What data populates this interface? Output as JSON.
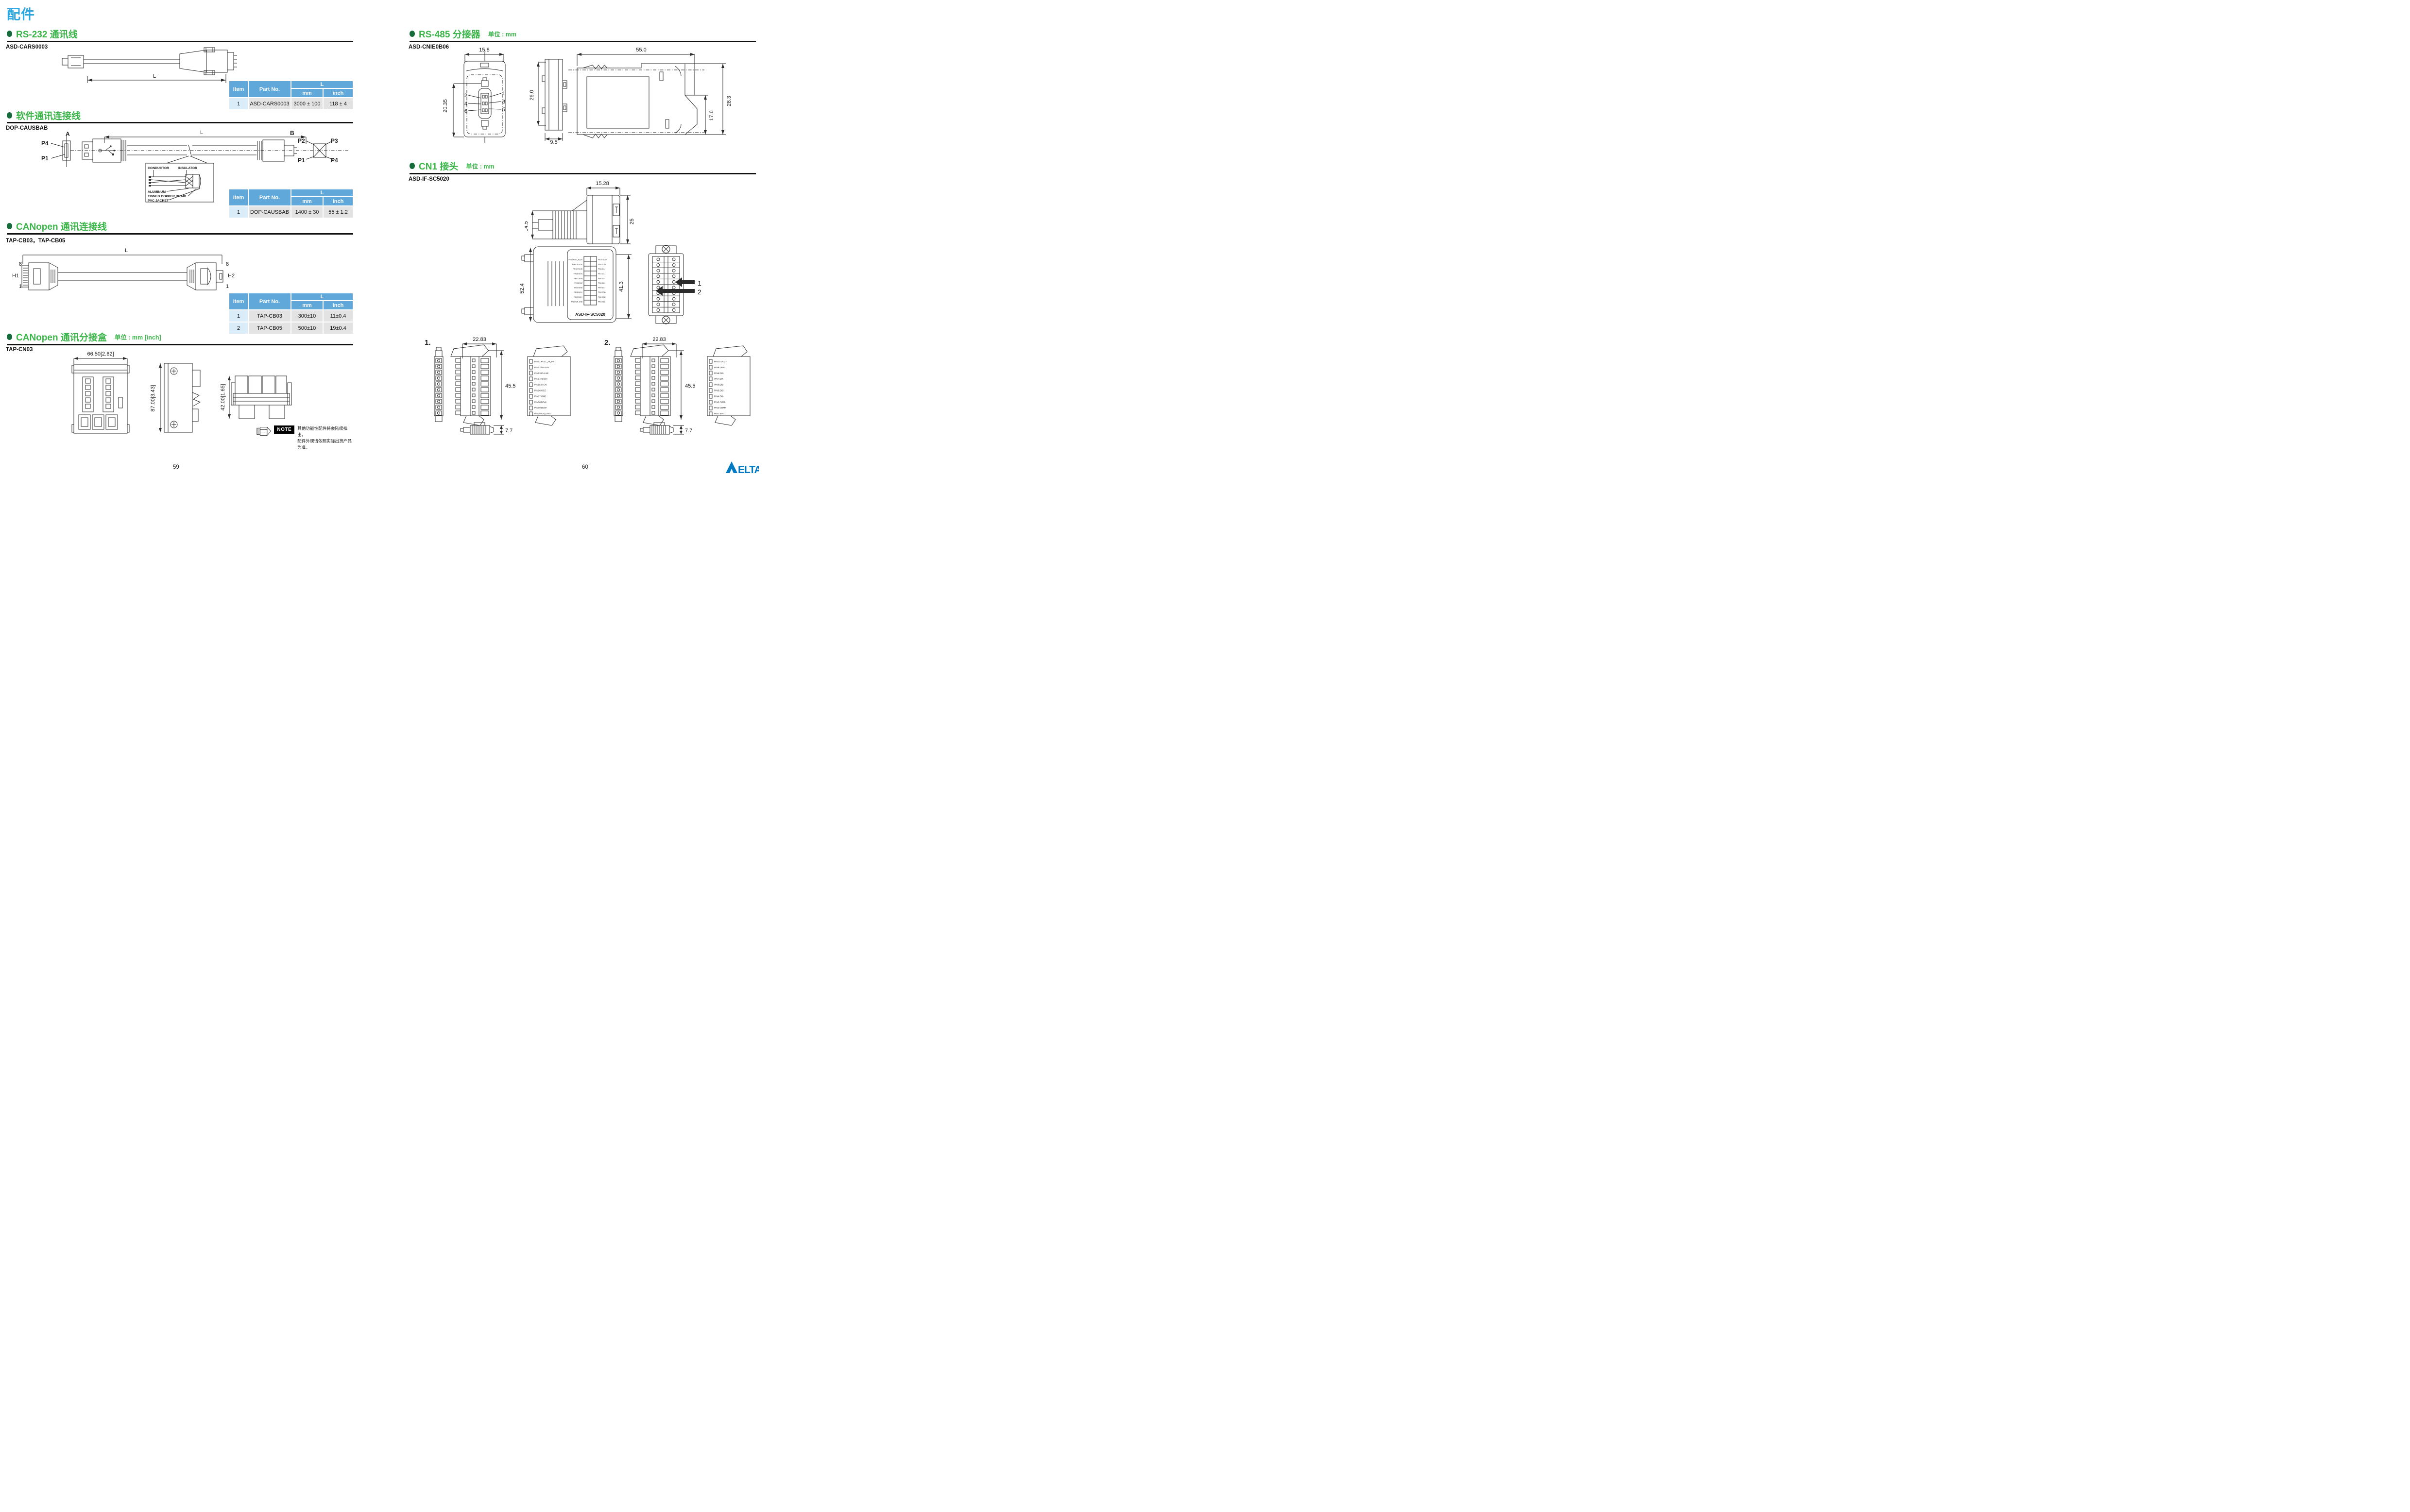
{
  "doc": {
    "title": "配件"
  },
  "pages": {
    "left_number": "59",
    "right_number": "60"
  },
  "colors": {
    "accent_blue": "#2EA7E0",
    "section_green": "#3BB54A",
    "bullet_green": "#156B3A",
    "table_header_blue": "#61A8DA",
    "table_item_bg": "#D9ECF8",
    "table_cell_bg": "#E3E3E3",
    "delta_blue": "#0079C1"
  },
  "rs232": {
    "title": "RS-232 通讯线",
    "part_no": "ASD-CARS0003",
    "dim_l": "L",
    "table": {
      "h_item": "Item",
      "h_part": "Part No.",
      "h_l": "L",
      "h_mm": "mm",
      "h_inch": "inch",
      "rows": [
        {
          "item": "1",
          "part": "ASD-CARS0003",
          "mm": "3000 ± 100",
          "inch": "118 ± 4"
        }
      ]
    }
  },
  "software": {
    "title": "软件通讯连接线",
    "part_no": "DOP-CAUSBAB",
    "dim_l": "L",
    "end_a": "A",
    "end_b": "B",
    "pa_top": "P4",
    "pa_bottom": "P1",
    "pb_tl": "P2",
    "pb_tr": "P3",
    "pb_bl": "P1",
    "pb_br": "P4",
    "detail": {
      "conductor": "CONDUCTOR",
      "insulator": "INSULATOR",
      "aluminum": "ALUMINUM",
      "braid": "TINNED COPPER BRAID",
      "jacket": "PVC JACKET"
    },
    "table": {
      "h_item": "Item",
      "h_part": "Part No.",
      "h_l": "L",
      "h_mm": "mm",
      "h_inch": "inch",
      "rows": [
        {
          "item": "1",
          "part": "DOP-CAUSBAB",
          "mm": "1400 ± 30",
          "inch": "55 ± 1.2"
        }
      ]
    }
  },
  "canopen_cable": {
    "title": "CANopen 通讯连接线",
    "part_no": "TAP-CB03，TAP-CB05",
    "dim_l": "L",
    "h1": "H1",
    "h2": "H2",
    "pin_top": "8",
    "pin_bottom": "1",
    "table": {
      "h_item": "Item",
      "h_part": "Part No.",
      "h_l": "L",
      "h_mm": "mm",
      "h_inch": "inch",
      "rows": [
        {
          "item": "1",
          "part": "TAP-CB03",
          "mm": "300±10",
          "inch": "11±0.4"
        },
        {
          "item": "2",
          "part": "TAP-CB05",
          "mm": "500±10",
          "inch": "19±0.4"
        }
      ]
    }
  },
  "canopen_tap": {
    "title": "CANopen 通讯分接盒",
    "unit": "单位 : mm [inch]",
    "part_no": "TAP-CN03",
    "dim_w": "66.50[2.62]",
    "dim_h": "87.00[3.43]",
    "dim_d": "42.00[1.65]",
    "note_label": "NOTE",
    "note_line1": "其他功能性配件将会陆续推出。",
    "note_line2": "配件外观请依照实际出货产品为准。"
  },
  "rs485": {
    "title": "RS-485 分接器",
    "unit": "单位 : mm",
    "part_no": "ASD-CNIE0B06",
    "dim_w": "15.8",
    "dim_h": "20.35",
    "pins_left": [
      "2",
      "4",
      "6"
    ],
    "pins_right": [
      "1",
      "3",
      "5"
    ],
    "dim_total_w": "55.0",
    "dim_side_h": "26.0",
    "dim_rail_h": "17.6",
    "dim_total_h": "28.3",
    "dim_depth": "9.5"
  },
  "cn1": {
    "title": "CN1 接头",
    "unit": "单位 : mm",
    "part_no": "ASD-IF-SC5020",
    "dim_top_w": "15.28",
    "dim_top_h1": "14.5",
    "dim_top_h2": "25",
    "dim_mid_h1": "52.4",
    "dim_mid_h2": "41.3",
    "mid_label": "ASD-IF-SC5020",
    "arrow1": "1",
    "arrow2": "2",
    "fig1_label": "1.",
    "fig2_label": "2.",
    "fig_dim_w": "22.83",
    "fig_dim_h": "45.5",
    "fig_dim_d": "7.7",
    "pins_left": [
      "PIN11:PULL_HI_PS",
      "PIN12:/PULSE",
      "PIN13:PULSE",
      "PIN14:/SIGN",
      "PIN15:SIGN",
      "PIN16:OCZ",
      "PIN17:GND",
      "PIN18:DO4+",
      "PIN19:DO3+",
      "PIN20:CN_GND"
    ],
    "pins_right": [
      "PIN10:DO2+",
      "PIN9:DO1+",
      "PIN8:DI7-",
      "PIN7:DI4-",
      "PIN6:DI3-",
      "PIN5:DI2-",
      "PIN4:DI1-",
      "PIN3:COM-",
      "PIN2:COM+",
      "PIN1:VDD"
    ]
  },
  "logo": {
    "text": "ELTA"
  }
}
